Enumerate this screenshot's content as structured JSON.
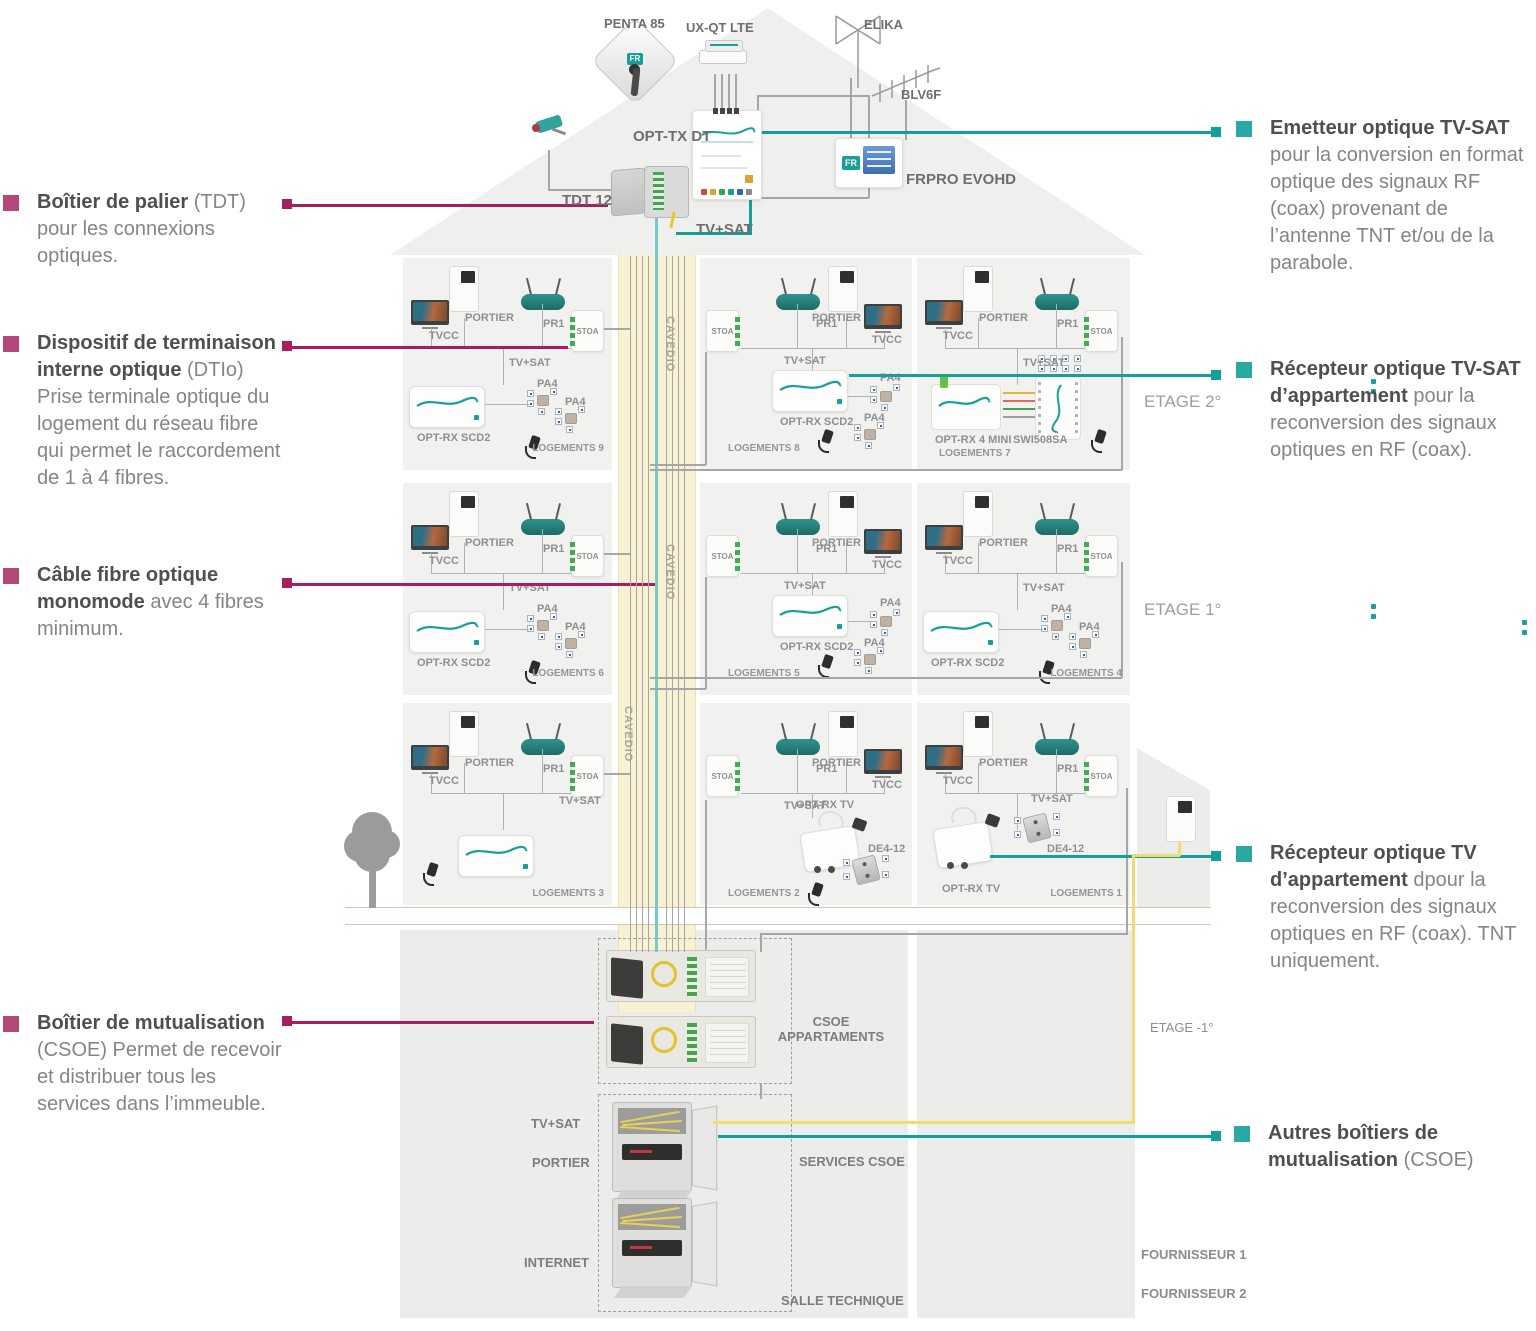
{
  "colors": {
    "teal": "#12a19a",
    "magenta": "#a81d5f",
    "bullet_left": "#b4487a",
    "bullet_right": "#2aa8a2",
    "yellow_fiber": "#f2dc6f",
    "aqua_fiber": "#74cbc7",
    "panel_gray": "#f1f1f0",
    "cavedio_band": "#f9f1d4"
  },
  "roof": {
    "brand": "FR",
    "penta_label": "PENTA 85",
    "uxqt_label": "UX-QT LTE",
    "elika_label": "ELIKA",
    "blv6f_label": "BLV6F",
    "opttx_label": "OPT-TX DT",
    "frpro_label": "FRPRO EVOHD",
    "tdt_label": "TDT 12",
    "tvsat_label": "TV+SAT"
  },
  "left_annotations": [
    {
      "bold": "Boîtier de palier",
      "normal": " (TDT) pour les connexions optiques."
    },
    {
      "bold": "Dispositif de terminaison interne optique",
      "normal": " (DTIo) Prise terminale optique du logement du réseau fibre qui permet le raccordement de 1 à 4 fibres."
    },
    {
      "bold": "Câble fibre optique monomode",
      "normal": " avec 4 fibres minimum."
    },
    {
      "bold": "Boîtier de mutualisation",
      "normal": " (CSOE) Permet de recevoir et distribuer tous les services dans l’immeuble."
    }
  ],
  "right_annotations": [
    {
      "bold": "Emetteur optique TV-SAT",
      "normal": " pour la conversion en format optique des signaux RF (coax) provenant de l’antenne TNT et/ou de la parabole."
    },
    {
      "bold": "Récepteur optique TV-SAT d’appartement",
      "normal": " pour la reconversion des signaux optiques en RF (coax)."
    },
    {
      "bold": "Récepteur optique TV d’appartement",
      "normal": " dpour la reconversion des signaux optiques en RF (coax). TNT uniquement."
    },
    {
      "bold": "Autres boîtiers de mutualisation",
      "normal": " (CSOE)"
    }
  ],
  "floor_labels": {
    "etage2": "ETAGE 2°",
    "etage1": "ETAGE 1°",
    "etage_minus1": "ETAGE -1°",
    "fournisseur1": "FOURNISSEUR 1",
    "fournisseur2": "FOURNISSEUR 2"
  },
  "cavedio_label": "CAVEDIO",
  "basement": {
    "csoe_line1": "CSOE",
    "csoe_line2": "APPARTAMENTS",
    "tvsat": "TV+SAT",
    "portier": "PORTIER",
    "internet": "INTERNET",
    "services": "SERVICES CSOE",
    "salle": "SALLE TECHNIQUE"
  },
  "units": [
    {
      "id": "u9",
      "variant": "std",
      "device": "scd2",
      "labels": {
        "tvcc": "TVCC",
        "portier": "PORTIER",
        "pr1": "PR1",
        "stoa": "STOA",
        "tvsat": "TV+SAT",
        "device": "OPT-RX SCD2",
        "pa4a": "PA4",
        "pa4b": "PA4",
        "logements": "LOGEMENTS 9"
      }
    },
    {
      "id": "u8",
      "variant": "mir",
      "device": "scd2",
      "labels": {
        "tvcc": "TVCC",
        "portier": "PORTIER",
        "pr1": "PR1",
        "stoa": "STOA",
        "tvsat": "TV+SAT",
        "device": "OPT-RX SCD2",
        "pa4a": "PA4",
        "pa4b": "PA4",
        "logements": "LOGEMENTS 8"
      }
    },
    {
      "id": "u7",
      "variant": "std",
      "device": "mini",
      "labels": {
        "tvcc": "TVCC",
        "portier": "PORTIER",
        "pr1": "PR1",
        "stoa": "STOA",
        "tvsat": "TV+SAT",
        "device": "OPT-RX 4 MINI",
        "swi": "SWI508SA",
        "logements": "LOGEMENTS 7"
      }
    },
    {
      "id": "u6",
      "variant": "std",
      "device": "scd2",
      "labels": {
        "tvcc": "TVCC",
        "portier": "PORTIER",
        "pr1": "PR1",
        "stoa": "STOA",
        "tvsat": "TV+SAT",
        "device": "OPT-RX SCD2",
        "pa4a": "PA4",
        "pa4b": "PA4",
        "logements": "LOGEMENTS 6"
      }
    },
    {
      "id": "u5",
      "variant": "mir",
      "device": "scd2",
      "labels": {
        "tvcc": "TVCC",
        "portier": "PORTIER",
        "pr1": "PR1",
        "stoa": "STOA",
        "tvsat": "TV+SAT",
        "device": "OPT-RX SCD2",
        "pa4a": "PA4",
        "pa4b": "PA4",
        "logements": "LOGEMENTS 5"
      }
    },
    {
      "id": "u4",
      "variant": "std",
      "device": "scd2",
      "labels": {
        "tvcc": "TVCC",
        "portier": "PORTIER",
        "pr1": "PR1",
        "stoa": "STOA",
        "tvsat": "TV+SAT",
        "device": "OPT-RX SCD2",
        "pa4a": "PA4",
        "pa4b": "PA4",
        "logements": "LOGEMENTS 4"
      }
    },
    {
      "id": "u3",
      "variant": "std",
      "device": "scd2nl",
      "labels": {
        "tvcc": "TVCC",
        "portier": "PORTIER",
        "pr1": "PR1",
        "stoa": "STOA",
        "tvsat": "TV+SAT",
        "logements": "LOGEMENTS 3"
      }
    },
    {
      "id": "u2",
      "variant": "mir",
      "device": "tv2",
      "labels": {
        "tvcc": "TVCC",
        "portier": "PORTIER",
        "pr1": "PR1",
        "stoa": "STOA",
        "tvsat": "TV+SAT",
        "device": "OPT-RX TV",
        "de412": "DE4-12",
        "logements": "LOGEMENTS 2"
      }
    },
    {
      "id": "u1",
      "variant": "std",
      "device": "tv",
      "labels": {
        "tvcc": "TVCC",
        "portier": "PORTIER",
        "pr1": "PR1",
        "stoa": "STOA",
        "tvsat": "TV+SAT",
        "device": "OPT-RX TV",
        "de412": "DE4-12",
        "logements": "LOGEMENTS 1"
      }
    }
  ]
}
